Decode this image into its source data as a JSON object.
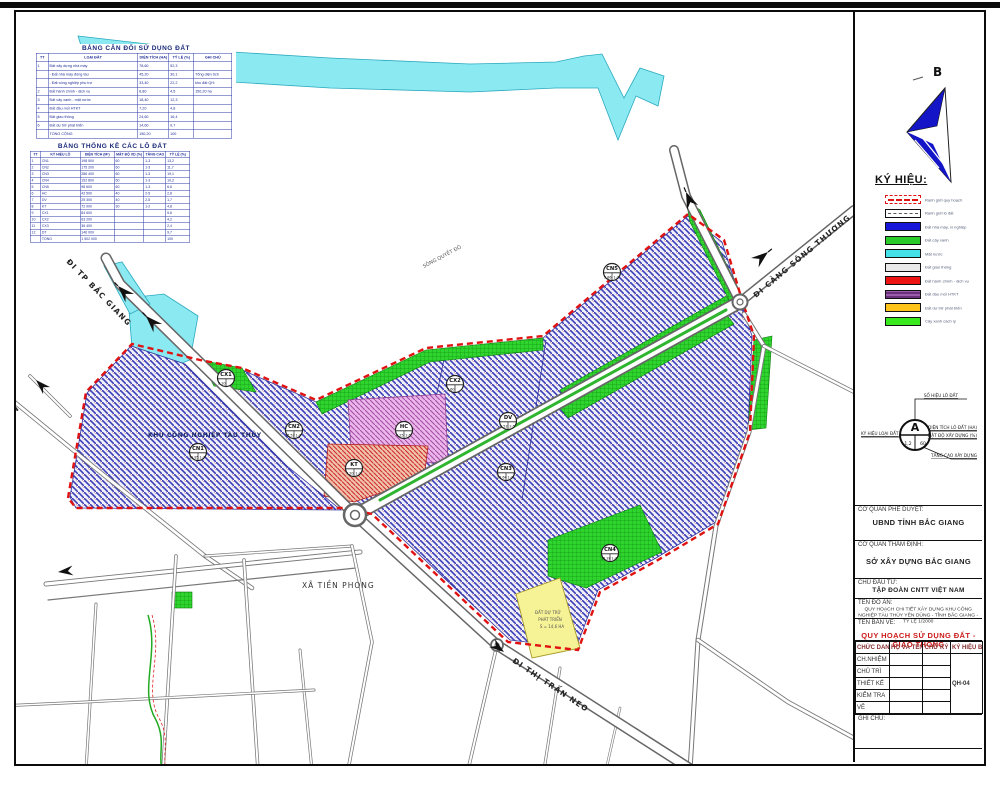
{
  "compass": {
    "north_label": "B"
  },
  "tables": {
    "land_balance": {
      "title": "BẢNG CÂN ĐỐI SỬ DỤNG ĐẤT",
      "rows": [
        [
          "TT",
          "LOẠI ĐẤT",
          "DIỆN TÍCH (HA)",
          "TỶ LỆ (%)",
          "GHI CHÚ"
        ],
        [
          "1",
          "Đất xây dựng nhà máy",
          "78,60",
          "52,3",
          ""
        ],
        [
          "",
          "- Đất nhà máy đóng tàu",
          "45,20",
          "30,1",
          "Tổng diện tích"
        ],
        [
          "",
          "- Đất công nghiệp phụ trợ",
          "33,40",
          "22,2",
          "khu đất QH:"
        ],
        [
          "2",
          "Đất hành chính - dịch vụ",
          "6,80",
          "4,5",
          "150,20 ha"
        ],
        [
          "3",
          "Đất cây xanh - mặt nước",
          "18,40",
          "12,3",
          ""
        ],
        [
          "4",
          "Đất đầu mối HTKT",
          "7,20",
          "4,8",
          ""
        ],
        [
          "5",
          "Đất giao thông",
          "24,60",
          "16,4",
          ""
        ],
        [
          "6",
          "Đất dự trữ phát triển",
          "14,60",
          "9,7",
          ""
        ],
        [
          "",
          "TỔNG CỘNG",
          "150,20",
          "100",
          ""
        ]
      ]
    },
    "lot_stats": {
      "title": "BẢNG THỐNG KÊ CÁC LÔ ĐẤT",
      "rows": [
        [
          "TT",
          "KÝ HIỆU LÔ",
          "DIỆN TÍCH (M²)",
          "MẬT ĐỘ XD (%)",
          "TẦNG CAO",
          "TỶ LỆ (%)"
        ],
        [
          "1",
          "CN1",
          "198 500",
          "60",
          "1-3",
          "13,2"
        ],
        [
          "2",
          "CN2",
          "175 200",
          "60",
          "1-3",
          "11,7"
        ],
        [
          "3",
          "CN3",
          "286 400",
          "60",
          "1-3",
          "19,1"
        ],
        [
          "4",
          "CN4",
          "152 800",
          "60",
          "1-3",
          "10,2"
        ],
        [
          "5",
          "CN5",
          "98 600",
          "60",
          "1-3",
          "6,6"
        ],
        [
          "6",
          "HC",
          "42 500",
          "40",
          "2-5",
          "2,8"
        ],
        [
          "7",
          "DV",
          "25 300",
          "40",
          "2-5",
          "1,7"
        ],
        [
          "8",
          "KT",
          "72 000",
          "30",
          "1-2",
          "4,8"
        ],
        [
          "9",
          "CX1",
          "84 600",
          "",
          "",
          "5,6"
        ],
        [
          "10",
          "CX2",
          "63 200",
          "",
          "",
          "4,2"
        ],
        [
          "11",
          "CX3",
          "36 400",
          "",
          "",
          "2,4"
        ],
        [
          "12",
          "DT",
          "146 000",
          "",
          "",
          "9,7"
        ],
        [
          "",
          "TỔNG",
          "1 502 000",
          "",
          "",
          "100"
        ]
      ]
    }
  },
  "legend": {
    "title": "KÝ HIỆU:",
    "items": [
      {
        "label": "Ranh giới quy hoạch",
        "style": "dash-red",
        "color": "#ffffff"
      },
      {
        "label": "Ranh giới lô đất",
        "style": "dash-black",
        "color": "#ffffff"
      },
      {
        "label": "Đất nhà máy, xí nghiệp",
        "color": "#1616d8"
      },
      {
        "label": "Đất cây xanh",
        "color": "#29cc29"
      },
      {
        "label": "Mặt nước",
        "color": "#46e0e8"
      },
      {
        "label": "Đất giao thông",
        "color": "#e9e9e9"
      },
      {
        "label": "Đất hành chính - dịch vụ",
        "color": "#ee1414"
      },
      {
        "label": "Đất đầu mối HTKT",
        "style": "stripe",
        "color": "#7a3d86"
      },
      {
        "label": "Đất dự trữ phát triển",
        "color": "#ffc41c"
      },
      {
        "label": "Cây xanh cách ly",
        "color": "#3ae81e"
      }
    ]
  },
  "lot_symbol": {
    "letter": "A",
    "val_left": "1,2",
    "val_right": "60",
    "label_top": "SỐ HIỆU LÔ ĐẤT",
    "label_right1": "DIỆN TÍCH LÔ ĐẤT (HA)",
    "label_right2": "MẬT ĐỘ XÂY DỰNG (%)",
    "label_left": "KÝ HIỆU LOẠI ĐẤT",
    "label_bottom": "TẦNG CAO XÂY DỰNG"
  },
  "title_block": {
    "approval_label": "CƠ QUAN PHÊ DUYỆT:",
    "approval_agency": "UBND TỈNH BẮC GIANG",
    "appraisal_label": "CƠ QUAN THẨM ĐỊNH:",
    "appraisal_agency": "SỞ XÂY DỰNG BẮC GIANG",
    "investor_label": "CHỦ ĐẦU TƯ:",
    "investor_name": "TẬP ĐOÀN CNTT VIỆT NAM",
    "project_label": "TÊN ĐỒ ÁN:",
    "project_name": "QUY HOẠCH CHI TIẾT XÂY DỰNG KHU CÔNG NGHIỆP TÀU THỦY YÊN DŨNG - TỈNH BẮC GIANG - TỶ LỆ 1/2000",
    "drawing_label": "TÊN BẢN VẼ:",
    "drawing_name": "QUY HOẠCH SỬ DỤNG ĐẤT - GIAO THÔNG",
    "drawing_color": "#cc1a1a",
    "note_label": "GHI CHÚ:",
    "sheet_no": "QH-04",
    "signature": {
      "headers": [
        "CHỨC DANH",
        "HỌ VÀ TÊN",
        "CHỮ KÝ",
        "KÝ HIỆU BV"
      ],
      "rows": [
        "CH.NHIỆM",
        "CHỦ TRÌ",
        "THIẾT KẾ",
        "KIỂM TRA",
        "VẼ"
      ]
    }
  },
  "map": {
    "labels": {
      "road_bac_giang": "ĐI TP BẮC GIANG",
      "road_song_thuong": "ĐI CẢNG SÔNG THƯƠNG",
      "road_neo": "ĐI THỊ TRẤN NEO",
      "commune": "XÃ TIỀN PHONG",
      "yen": "YÊN",
      "river": "SÔNG QUYẾT ĐÔ",
      "zone_name": "KHU CÔNG NGHIỆP TÀU THỦY",
      "reserve_1": "ĐẤT DỰ TRỮ",
      "reserve_2": "PHÁT TRIỂN",
      "reserve_3": "S = 14,6 HA"
    },
    "colors": {
      "water": "#8be9f2",
      "industrial_hatch": "#3d3db8",
      "green": "#2fd42f",
      "pink": "#ecb6ec",
      "red_zone": "#cf2b2b",
      "yellow_zone": "#f6f296",
      "boundary": "#e01212"
    },
    "lots": [
      {
        "id": "CN1",
        "area": "19,85",
        "fl": "1-3",
        "x": 198,
        "y": 452
      },
      {
        "id": "CN2",
        "area": "17,52",
        "fl": "1-3",
        "x": 294,
        "y": 430
      },
      {
        "id": "CX1",
        "area": "2,10",
        "fl": "",
        "x": 226,
        "y": 378
      },
      {
        "id": "HC",
        "area": "4,25",
        "fl": "2-5",
        "x": 404,
        "y": 430
      },
      {
        "id": "KT",
        "area": "7,20",
        "fl": "1-2",
        "x": 354,
        "y": 468
      },
      {
        "id": "CX2",
        "area": "3,60",
        "fl": "",
        "x": 455,
        "y": 384
      },
      {
        "id": "DV",
        "area": "2,53",
        "fl": "2-5",
        "x": 508,
        "y": 421
      },
      {
        "id": "CN3",
        "area": "28,64",
        "fl": "1-3",
        "x": 506,
        "y": 472
      },
      {
        "id": "CN4",
        "area": "15,28",
        "fl": "1-3",
        "x": 610,
        "y": 553
      },
      {
        "id": "CN5",
        "area": "9,86",
        "fl": "1-3",
        "x": 612,
        "y": 272
      }
    ]
  }
}
